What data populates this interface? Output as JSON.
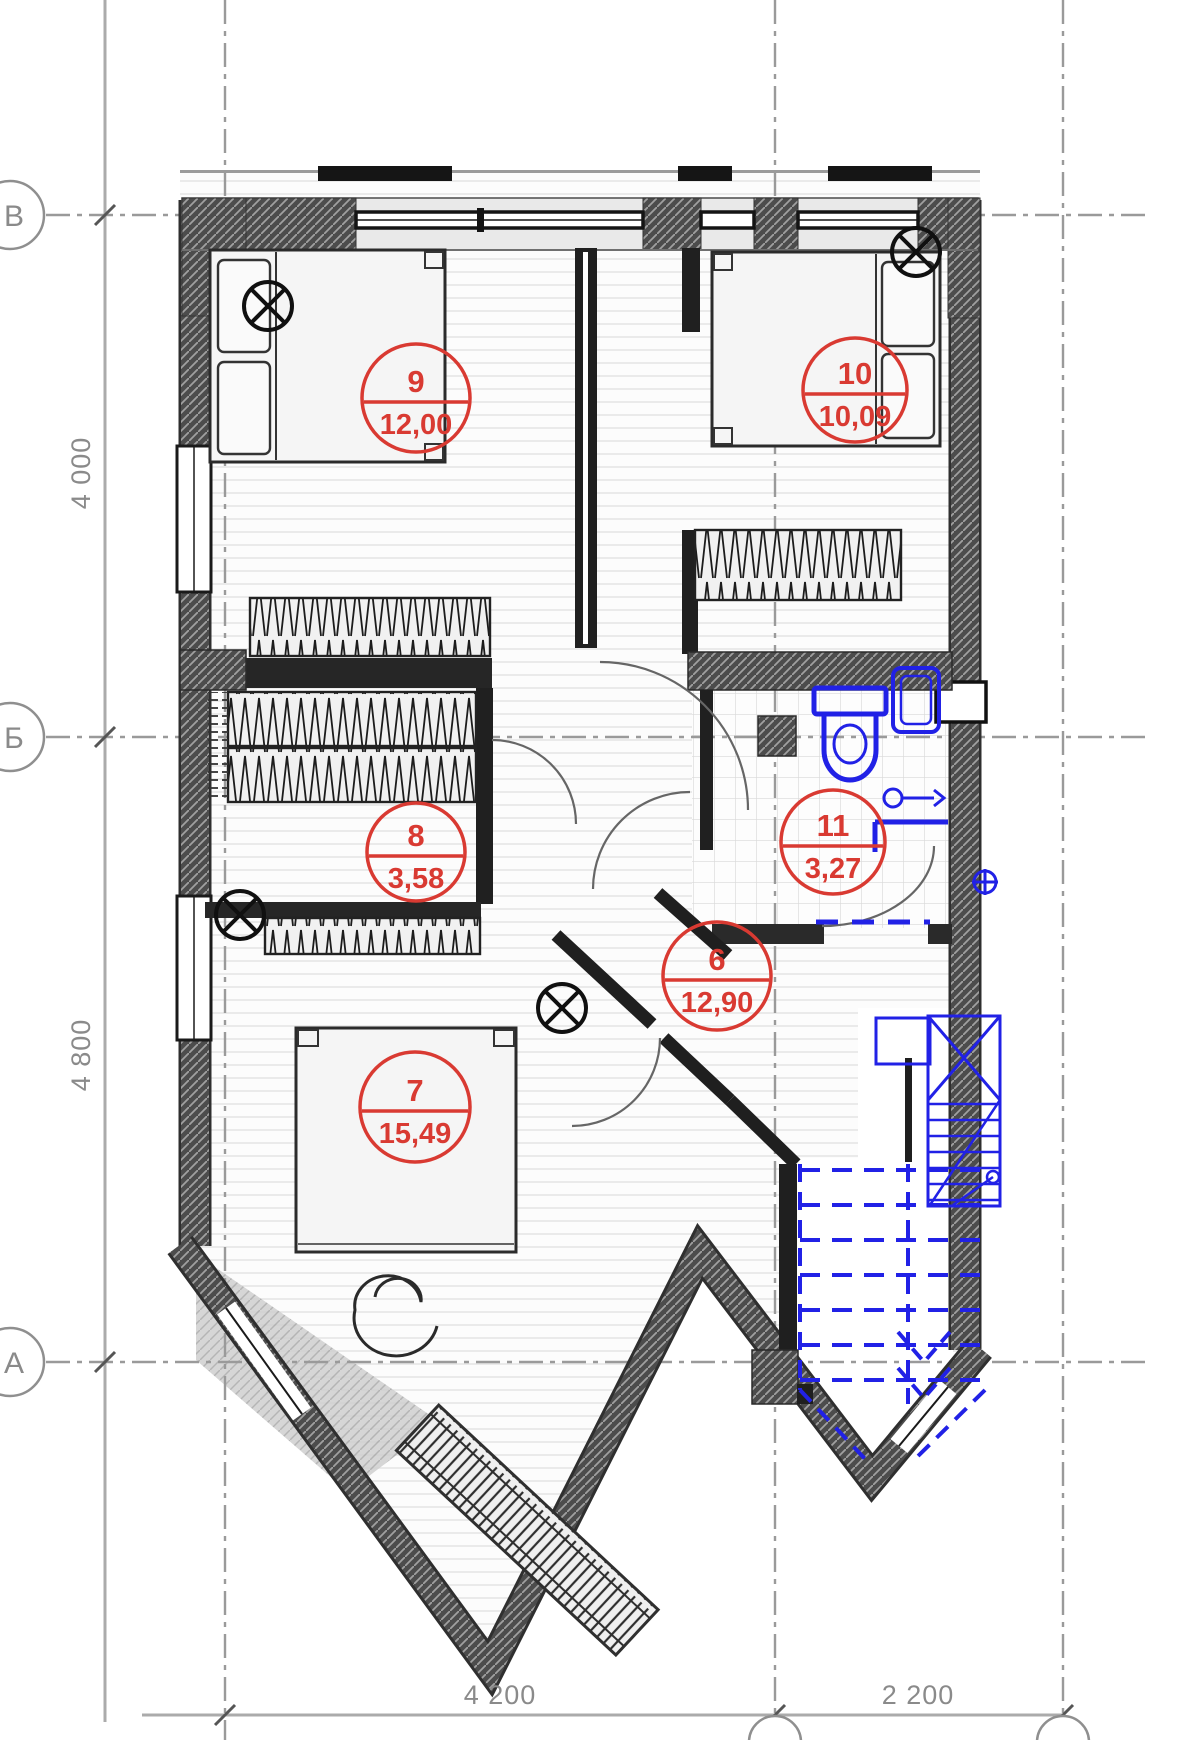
{
  "plan": {
    "type": "architectural-floor-plan",
    "axis_rows": [
      "В",
      "Б",
      "А"
    ],
    "dims_left": [
      "4 000",
      "4 800"
    ],
    "dims_bottom": [
      "4 200",
      "2 200"
    ],
    "rooms": [
      {
        "number": "9",
        "area": "12,00"
      },
      {
        "number": "10",
        "area": "10,09"
      },
      {
        "number": "8",
        "area": "3,58"
      },
      {
        "number": "11",
        "area": "3,27"
      },
      {
        "number": "6",
        "area": "12,90"
      },
      {
        "number": "7",
        "area": "15,49"
      }
    ],
    "colors": {
      "label_red": "#d93a32",
      "plumbing_blue": "#2121e6",
      "wall_dark": "#4c4c4c",
      "grid_gray": "#8f8f8f"
    }
  }
}
